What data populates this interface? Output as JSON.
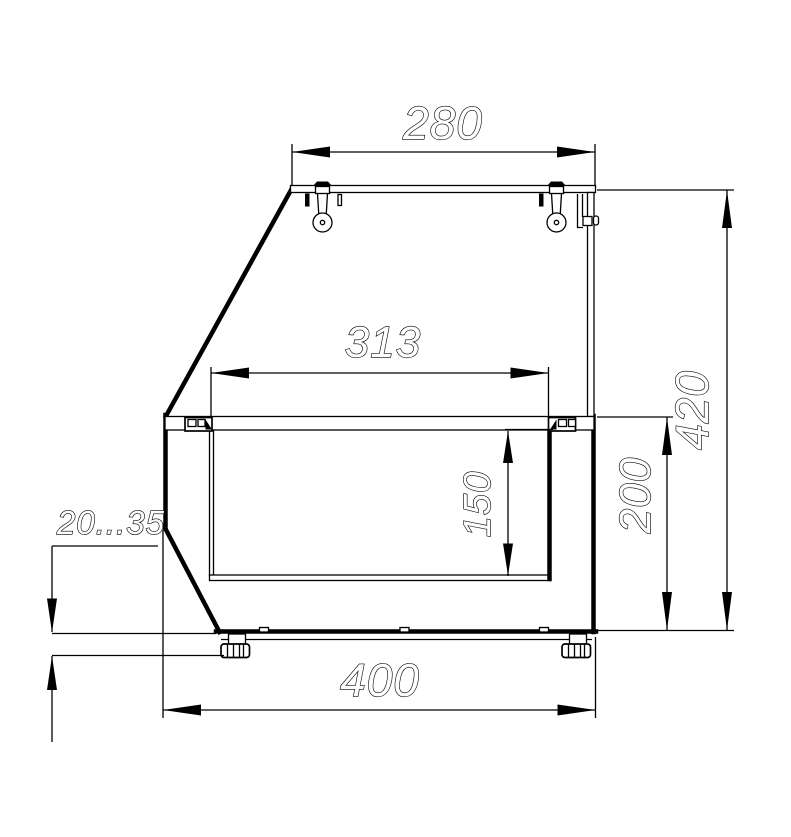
{
  "drawing": {
    "background_color": "#ffffff",
    "line_color": "#000000",
    "dimensions": {
      "top_width": "280",
      "inner_width": "313",
      "cavity_height": "150",
      "lower_height": "200",
      "total_height": "420",
      "base_width": "400",
      "feet_adjust_range": "20...35"
    }
  }
}
